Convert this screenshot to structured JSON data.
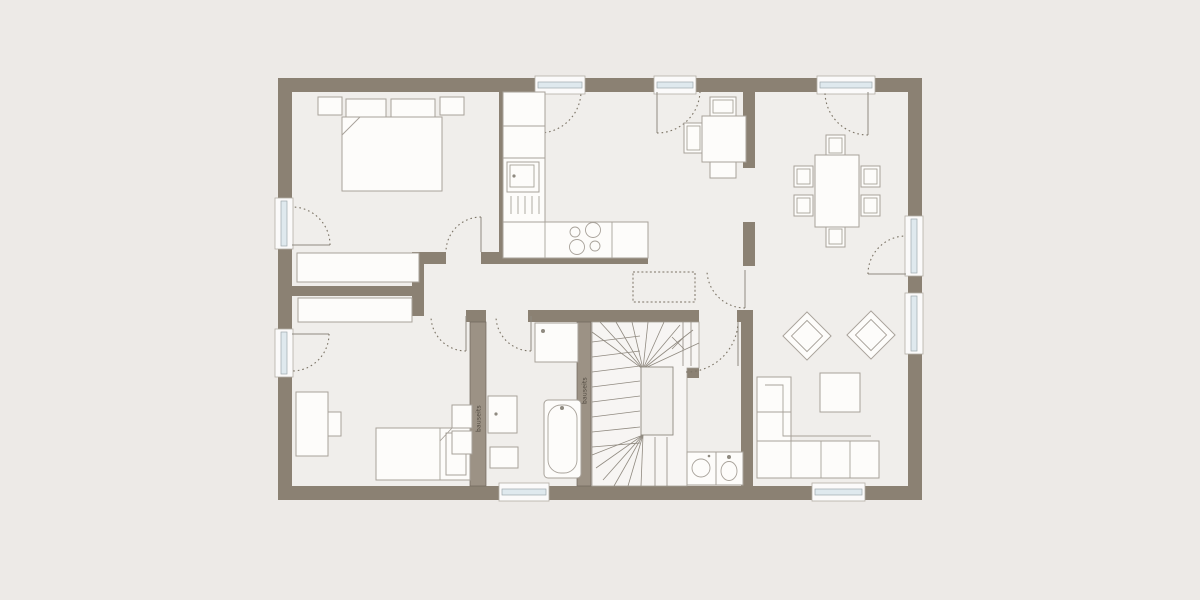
{
  "labels": {
    "onsite_note": "bauseits"
  },
  "colors": {
    "background": "#edeae7",
    "floor": "#f0eeeb",
    "wall": "#8b8173",
    "wall_light": "#9c9285",
    "window_glass": "#dfe9ee",
    "swing": "#7b7365",
    "stair_bg": "#f7f5f3"
  },
  "legend_icons": [
    "double-bed-icon",
    "single-bed-icon",
    "desk-icon",
    "wardrobe-icon",
    "shelf-icon",
    "kitchen-counter-icon",
    "sink-icon",
    "cooktop-icon",
    "breakfast-table-icon",
    "dining-table-icon",
    "chair-icon",
    "armchair-icon",
    "coffee-table-icon",
    "corner-sofa-icon",
    "shower-icon",
    "washbasin-icon",
    "bathtub-icon",
    "washing-machine-icon",
    "toilet-icon",
    "staircase-icon",
    "door-swing-icon",
    "window-icon",
    "dashed-wardrobe-icon"
  ]
}
